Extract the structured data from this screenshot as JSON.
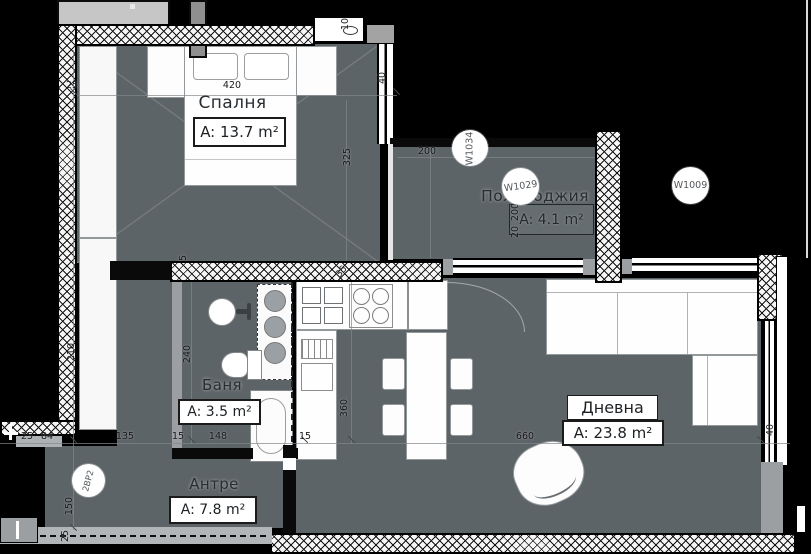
{
  "rooms": {
    "bedroom": {
      "name": "Спалня",
      "area": "A: 13.7 m²"
    },
    "loggia": {
      "name": "Полулоджия",
      "area": "A: 4.1 m²"
    },
    "bathroom": {
      "name": "Баня",
      "area": "A: 3.5 m²"
    },
    "hallway": {
      "name": "Антре",
      "area": "A: 7.8 m²"
    },
    "living": {
      "name": "Дневна",
      "area": "A: 23.8 m²"
    }
  },
  "markers": {
    "w1034": "W1034",
    "w1029": "W1029",
    "w1009": "W1009",
    "unit_code": "2BP2"
  },
  "dims": {
    "bedroom_side": "25",
    "bedroom_width": "420",
    "bedroom_depth": "325",
    "bedroom_window": "40",
    "shaft_width": "10",
    "loggia_width": "200",
    "loggia_depth": "200",
    "loggia_small": "20",
    "wardrobe_depth": "210",
    "bath_depth": "240",
    "kitchen_depth": "360",
    "wall_small": "5",
    "wall_thick": "35",
    "row_25": "25",
    "row_84": "84",
    "row_135": "135",
    "row_15a": "15",
    "row_148": "148",
    "row_15b": "15",
    "row_660": "660",
    "living_window": "40",
    "hall_depth": "150",
    "hall_wall": "25"
  },
  "colors": {
    "floor": "#5d6468",
    "wall_fill": "#f6f6f6",
    "background": "#000000"
  }
}
